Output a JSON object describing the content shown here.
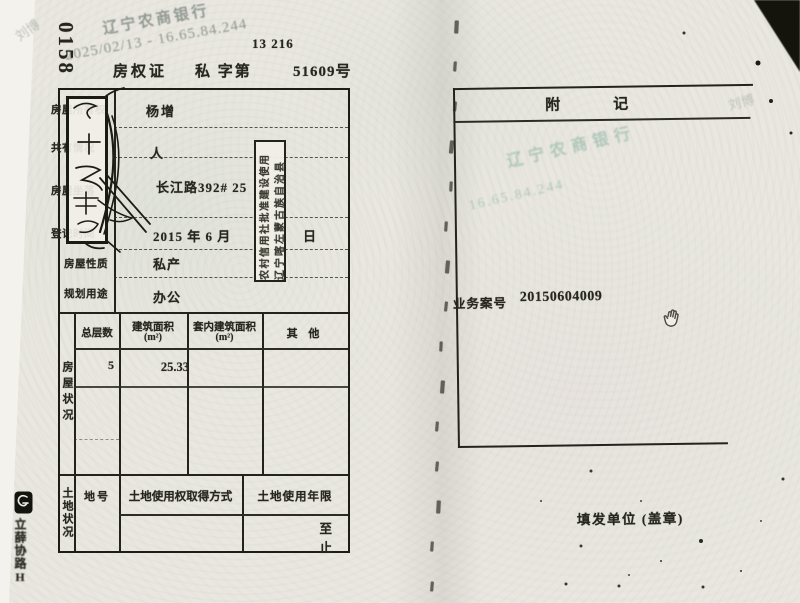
{
  "scan": {
    "serial_number": "0158",
    "corner_note": "13 216",
    "watermark": {
      "bank_name": "辽宁农商银行",
      "timestamp_ip": "2025/02/13 - 16.65.84.244",
      "ip_fragment": "16.65.84.244",
      "name_overlay": "刘博"
    },
    "margin_vertical_marks": "立薛协路H"
  },
  "certificate": {
    "title": "房权证",
    "category_prefix": "私 字第",
    "number": "51609号"
  },
  "owner_table": {
    "rows": [
      {
        "label": "房屋所有权人",
        "value": "杨增"
      },
      {
        "label": "共有情况",
        "value": "人"
      },
      {
        "label": "房屋坐落",
        "value": "长江路392# 25"
      },
      {
        "label": "登记时间",
        "value": "2015 年 6 月",
        "suffix": "日"
      },
      {
        "label": "房屋性质",
        "value": "私产"
      },
      {
        "label": "规划用途",
        "value": "办公"
      }
    ]
  },
  "house_status": {
    "section_label": "房屋状况",
    "col_total_floors": "总层数",
    "col_floor_area_l1": "建筑面积",
    "col_floor_area_l2": "(m²)",
    "col_inner_area_l1": "套内建筑面积",
    "col_inner_area_l2": "(m²)",
    "col_other": "其  他",
    "total_floors": "5",
    "floor_area": "25.33"
  },
  "land_status": {
    "section_label": "土地状况",
    "land_no_label": "地号",
    "acquisition_label": "土地使用权取得方式",
    "tenure_label": "土地使用年限",
    "tenure_from": "至",
    "tenure_to": "止"
  },
  "side_stamp": {
    "line1": "农村信用社批准建设使用",
    "line2": "辽宁喀左蒙古族自治县"
  },
  "annex": {
    "title_char1": "附",
    "title_char2": "记",
    "case_label": "业务案号",
    "case_number": "20150604009",
    "issuer_label": "填发单位 (盖章)"
  },
  "fold_marks_count": 15
}
